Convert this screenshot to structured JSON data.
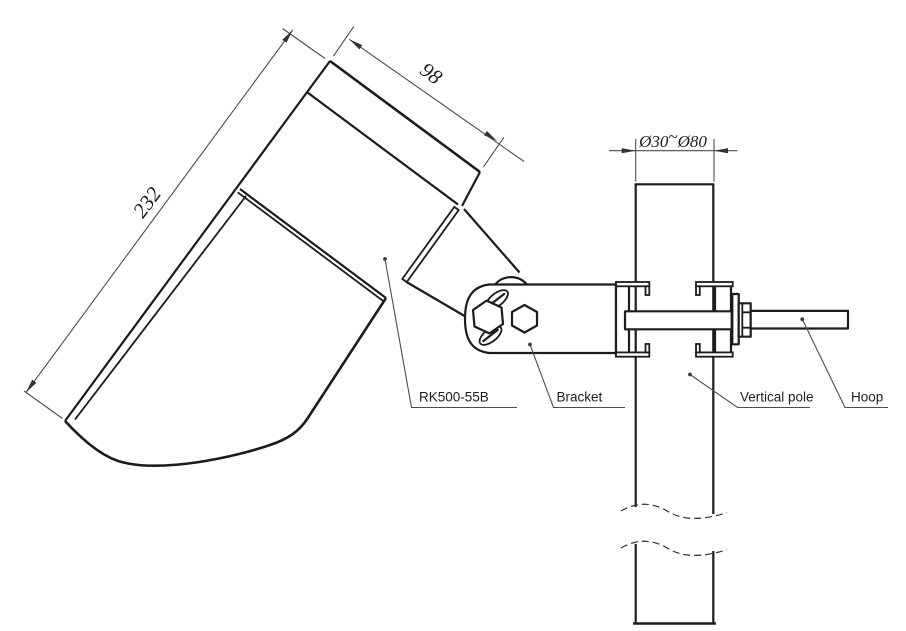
{
  "diagram": {
    "dimensions": {
      "sensor_length": "232",
      "sensor_top_width": "98",
      "pole_diameter": {
        "p1": "Ø30",
        "tilde": "~",
        "p2": "Ø80"
      }
    },
    "labels": {
      "sensor": "RK500-55B",
      "bracket": "Bracket",
      "pole": "Vertical pole",
      "hoop": "Hoop"
    },
    "colors": {
      "outline": "#1c1c1c",
      "thin_line": "#4d4d4d",
      "text": "#1c1c1c",
      "background": "#ffffff"
    }
  }
}
